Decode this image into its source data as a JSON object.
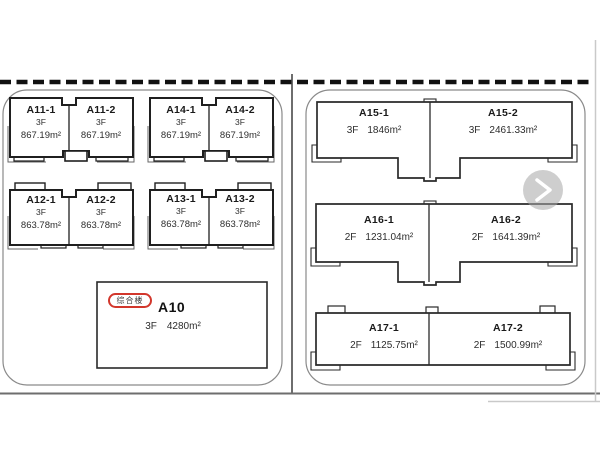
{
  "colors": {
    "building_outline": "#1f1f1f",
    "parcel_border": "#8a8a8a",
    "road_dash": "#111111",
    "road_line": "#6e6e6e",
    "parcel_divider": "#4a4a4a",
    "badge_red": "#d2372c",
    "chevron_circle": "#a6a6a6",
    "chevron_arrow": "#ffffff"
  },
  "icons": {
    "next": "chevron-right"
  },
  "left_parcel": {
    "pairs": [
      {
        "id": "A11",
        "units": [
          {
            "name": "A11-1",
            "floor": "3F",
            "area": "867.19m²"
          },
          {
            "name": "A11-2",
            "floor": "3F",
            "area": "867.19m²"
          }
        ]
      },
      {
        "id": "A14",
        "units": [
          {
            "name": "A14-1",
            "floor": "3F",
            "area": "867.19m²"
          },
          {
            "name": "A14-2",
            "floor": "3F",
            "area": "867.19m²"
          }
        ]
      },
      {
        "id": "A12",
        "units": [
          {
            "name": "A12-1",
            "floor": "3F",
            "area": "863.78m²"
          },
          {
            "name": "A12-2",
            "floor": "3F",
            "area": "863.78m²"
          }
        ]
      },
      {
        "id": "A13",
        "units": [
          {
            "name": "A13-1",
            "floor": "3F",
            "area": "863.78m²"
          },
          {
            "name": "A13-2",
            "floor": "3F",
            "area": "863.78m²"
          }
        ]
      }
    ],
    "a10": {
      "tag": "综合楼",
      "name": "A10",
      "floor": "3F",
      "area": "4280m²"
    }
  },
  "right_parcel": {
    "slabs": [
      {
        "id": "A15",
        "units": [
          {
            "name": "A15-1",
            "floor": "3F",
            "area": "1846m²"
          },
          {
            "name": "A15-2",
            "floor": "3F",
            "area": "2461.33m²"
          }
        ]
      },
      {
        "id": "A16",
        "units": [
          {
            "name": "A16-1",
            "floor": "2F",
            "area": "1231.04m²"
          },
          {
            "name": "A16-2",
            "floor": "2F",
            "area": "1641.39m²"
          }
        ]
      },
      {
        "id": "A17",
        "units": [
          {
            "name": "A17-1",
            "floor": "2F",
            "area": "1125.75m²"
          },
          {
            "name": "A17-2",
            "floor": "2F",
            "area": "1500.99m²"
          }
        ]
      }
    ]
  }
}
